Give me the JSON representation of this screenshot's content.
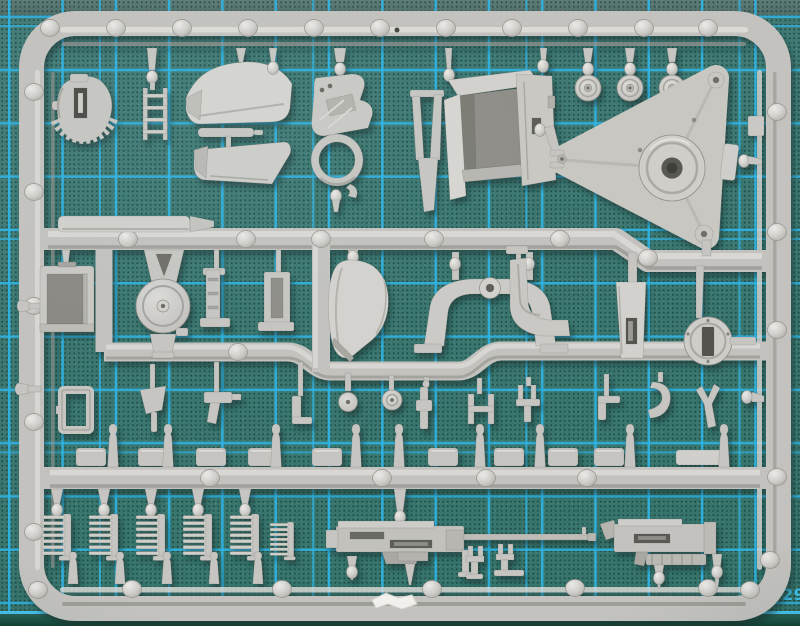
{
  "scene": {
    "type": "photograph",
    "subject": "Grey injection-molded model kit sprue with parts, lying on a cyan self-healing cutting mat",
    "view": "top-down"
  },
  "mat": {
    "ruler_label": "29",
    "grid_cell_px": 53,
    "colors": {
      "base": "#3e7a74",
      "grid_line": "#2fb4e4",
      "ruler_line": "#49c2ec",
      "top_band": "#55736f",
      "below_ruler": "#1d5547"
    }
  },
  "sprue": {
    "colors": {
      "plastic": "#c6c5c1",
      "plastic_light": "#e4e3df",
      "plastic_dark": "#8f8e89",
      "hole_dark": "#55544f",
      "cast_shadow": "#0a2c30"
    },
    "parts": [
      {
        "id": "gear-cam-plate",
        "label": "toothed cam plate"
      },
      {
        "id": "ladder",
        "label": "ladder"
      },
      {
        "id": "hull-panels",
        "label": "hull / fender panels"
      },
      {
        "id": "ring-mount",
        "label": "ring mount bracket"
      },
      {
        "id": "casemate-box",
        "label": "armoured box with fork and door"
      },
      {
        "id": "road-wheels",
        "label": "three small road wheels"
      },
      {
        "id": "carriage-triangle",
        "label": "gun carriage triangular plate"
      },
      {
        "id": "stowage-box",
        "label": "stowage box"
      },
      {
        "id": "idler-wheel",
        "label": "A-frame with idler wheel"
      },
      {
        "id": "mount-brackets",
        "label": "mounting brackets"
      },
      {
        "id": "curved-panel",
        "label": "curved fender panel"
      },
      {
        "id": "u-bracket",
        "label": "U-shaped carrier bracket"
      },
      {
        "id": "step-bracket",
        "label": "step bracket"
      },
      {
        "id": "slot-plate",
        "label": "slotted plate"
      },
      {
        "id": "slotted-drum",
        "label": "slotted drum cap"
      },
      {
        "id": "open-frame",
        "label": "small open frame"
      },
      {
        "id": "tool-row",
        "label": "row of small tools and fittings"
      },
      {
        "id": "panel-row",
        "label": "row of small mounting panels"
      },
      {
        "id": "gate-bottles",
        "label": "sprue gate bottles"
      },
      {
        "id": "track-combs",
        "label": "track tooth strips"
      },
      {
        "id": "machine-gun-large",
        "label": "heavy machine gun"
      },
      {
        "id": "tripod-clamps",
        "label": "tripod clamp pieces"
      },
      {
        "id": "machine-gun-small",
        "label": "light machine gun"
      },
      {
        "id": "plank-strip",
        "label": "flat plank strip"
      },
      {
        "id": "ejector-bumps",
        "label": "round ejector bumps on rails"
      },
      {
        "id": "paint-chip",
        "label": "white chipped spot on bottom rail"
      }
    ]
  }
}
